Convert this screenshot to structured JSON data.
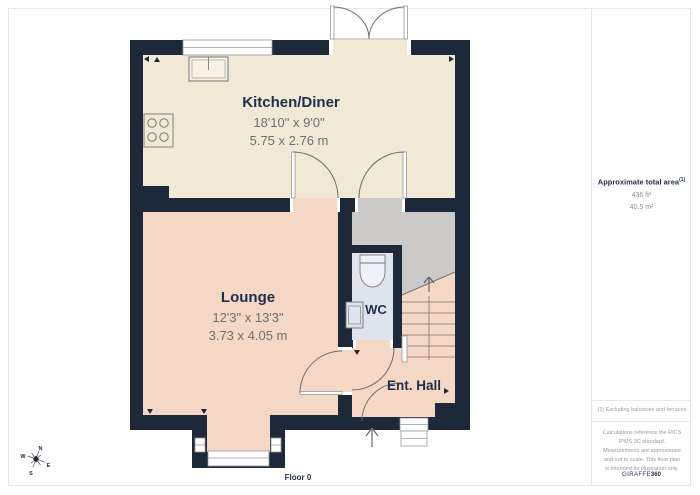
{
  "plan": {
    "floor_label": "Floor 0",
    "rooms": {
      "kitchen": {
        "name": "Kitchen/Diner",
        "imperial": "18'10\" x 9'0\"",
        "metric": "5.75 x 2.76 m"
      },
      "lounge": {
        "name": "Lounge",
        "imperial": "12'3\" x 13'3\"",
        "metric": "3.73 x 4.05 m"
      },
      "wc": {
        "name": "WC"
      },
      "hall": {
        "name": "Ent. Hall"
      }
    },
    "compass": {
      "n": "N",
      "e": "E",
      "s": "S",
      "w": "W"
    }
  },
  "sidebar": {
    "area_title": "Approximate total area",
    "area_sup": "(1)",
    "area_imperial": "436 ft²",
    "area_metric": "40.5 m²",
    "footnote": "(1) Excluding balconies and terraces",
    "disclaimer": "Calculations reference the RICS IPMS 3C standard. Measurements are approximate and not to scale. This floor plan is intended for illustration only.",
    "brand": {
      "name": "GIRAFFE",
      "suffix": "360"
    }
  },
  "colors": {
    "wall": "#1d2838",
    "kitchen_floor": "#f0e9d6",
    "lounge_floor": "#f5d7c5",
    "wc_floor": "#dee3ec",
    "landing_floor": "#cbcac8",
    "label_text": "#20304a",
    "dims_text": "#6f6f6f"
  }
}
